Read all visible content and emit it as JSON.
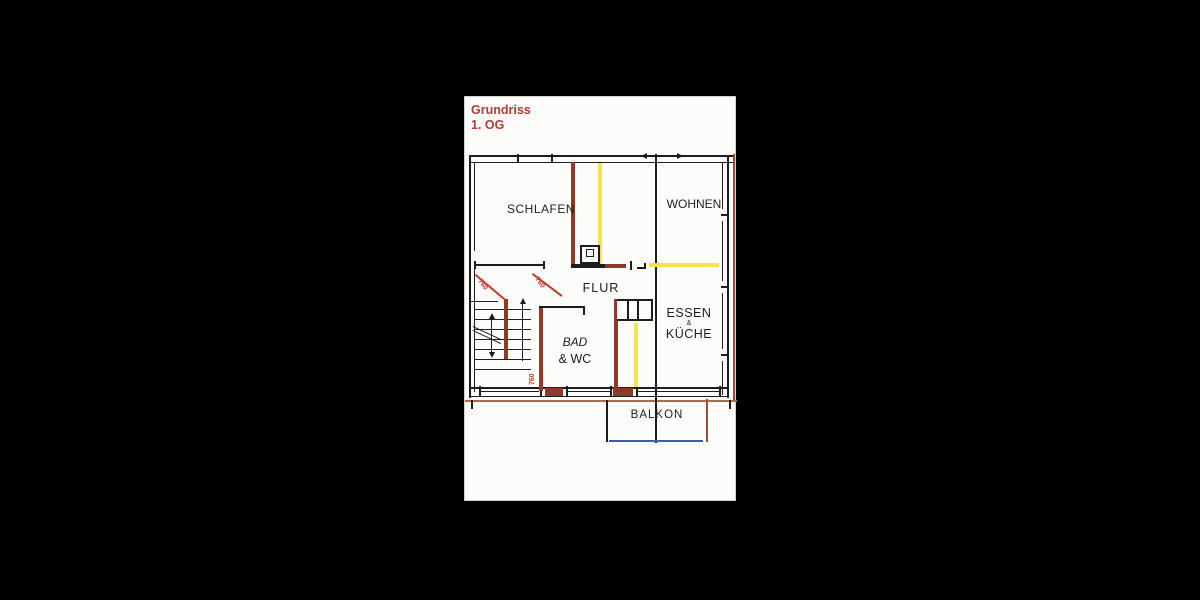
{
  "viewer": {
    "background": "#000000"
  },
  "document": {
    "title": {
      "line1": "Grundriss",
      "line2": "1. OG",
      "color": "#b13936"
    },
    "floor_plan": {
      "rooms": [
        {
          "name": "schlafen",
          "label": "SCHLAFEN"
        },
        {
          "name": "wohnen",
          "label": "WOHNEN"
        },
        {
          "name": "flur",
          "label": "FLUR"
        },
        {
          "name": "bad-wc",
          "label_line1": "BAD",
          "label_line2": "& WC"
        },
        {
          "name": "essen-kueche",
          "label_line1": "ESSEN",
          "label_connector": "&",
          "label_line2": "KÜCHE"
        },
        {
          "name": "balkon",
          "label": "BALKON"
        }
      ],
      "dimension_annotations": [
        {
          "value": "760",
          "location": "entry-door-swing-left"
        },
        {
          "value": "760",
          "location": "entry-door-swing-right"
        },
        {
          "value": "760",
          "location": "bad-wc-door"
        }
      ],
      "colors": {
        "wall_black": "#1d1d1d",
        "wall_brown": "#8e3a28",
        "edge_brown": "#9a4a38",
        "highlight_yellow": "#f5e34b",
        "annotation_red": "#c33a2c",
        "balcony_blue": "#3a5ea6"
      }
    }
  }
}
